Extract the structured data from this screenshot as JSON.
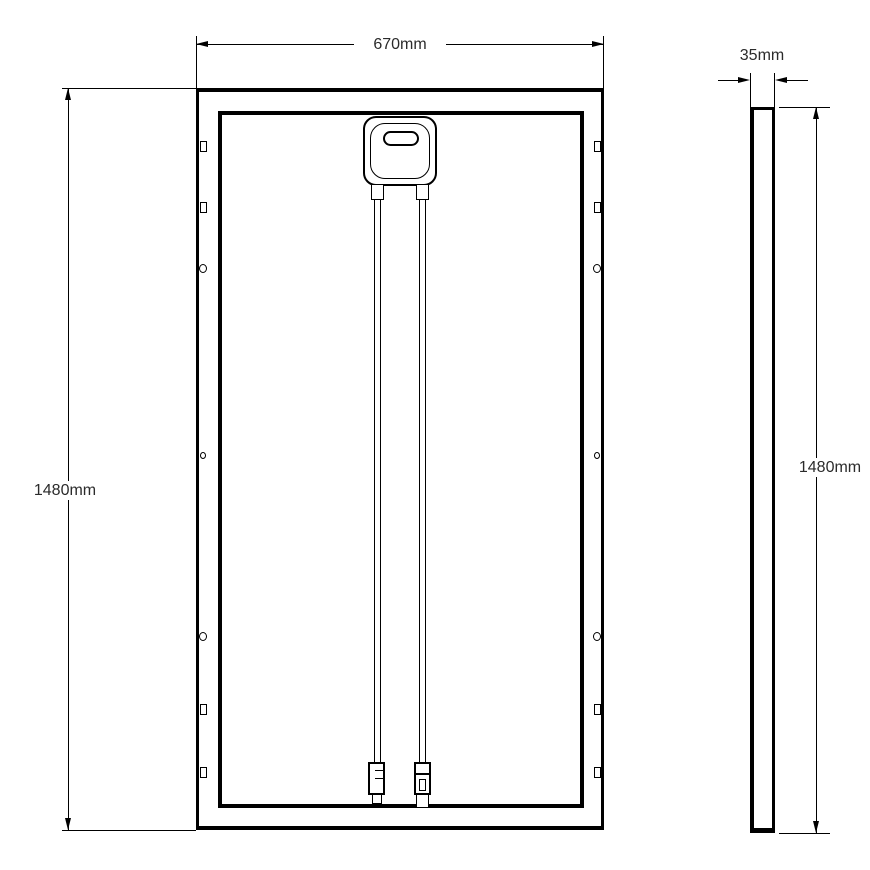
{
  "drawing": {
    "type": "technical-dimension-drawing",
    "front_view": {
      "width_label": "670mm",
      "height_label": "1480mm",
      "components": {
        "junction_box": "junction-box",
        "cable_left": "cable",
        "cable_right": "cable",
        "connector_left": "mc4-connector-male",
        "connector_right": "mc4-connector-female",
        "mounting_features": "slots-and-holes"
      }
    },
    "side_view": {
      "thickness_label": "35mm",
      "height_label": "1480mm"
    },
    "colors": {
      "line": "#000000",
      "text": "#2b2b2b",
      "background": "#ffffff"
    }
  }
}
